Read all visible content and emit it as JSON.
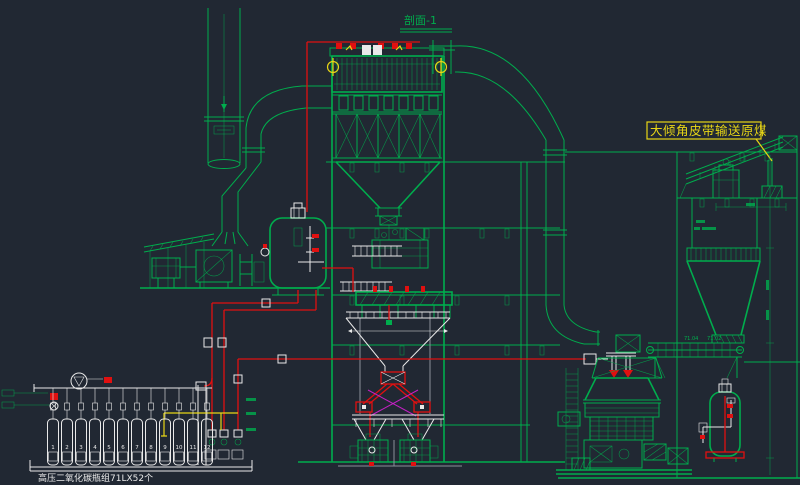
{
  "colors": {
    "background": "#212833",
    "green": "#00ad4d",
    "red": "#e01010",
    "yellow": "#e8d616",
    "white": "#e9e9e9",
    "magenta": "#c520c5",
    "gray": "#8a909a"
  },
  "labels": {
    "section": "剖面-1",
    "conveyor_note": "大倾角皮带输送原煤",
    "cylinder_caption": "高压二氧化碳瓶组71LX52个",
    "dim_left": "71.04",
    "dim_right": "71.02"
  },
  "cylinders": {
    "count": 12,
    "numbers": [
      "1",
      "2",
      "3",
      "4",
      "5",
      "6",
      "7",
      "8",
      "9",
      "10",
      "11",
      "12"
    ]
  }
}
